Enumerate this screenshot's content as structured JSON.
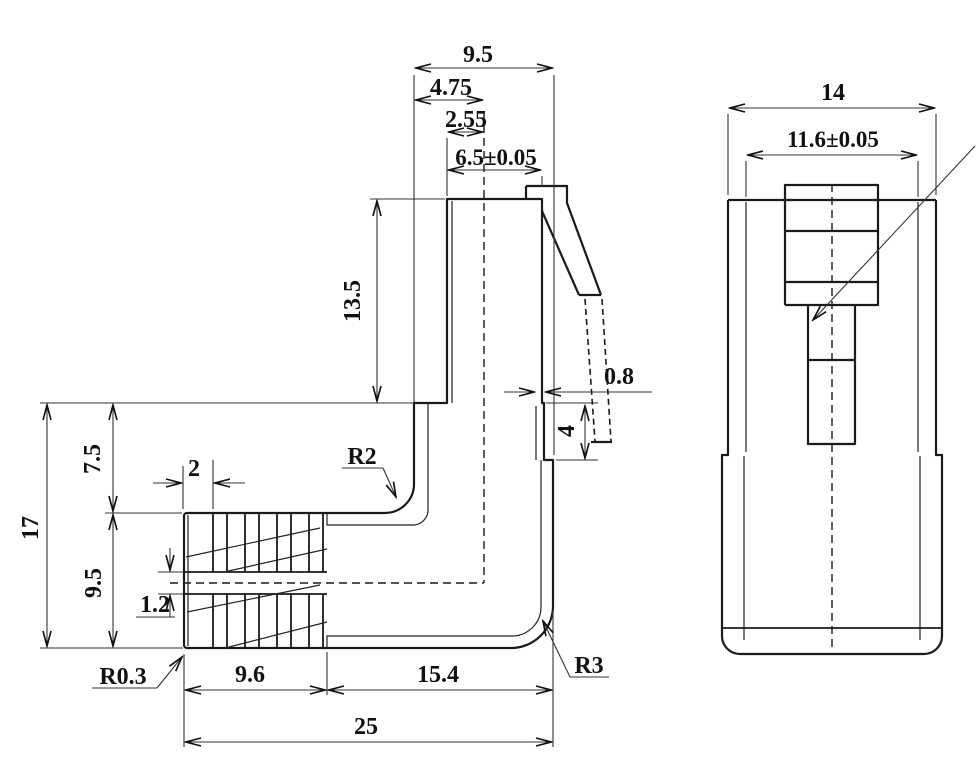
{
  "side_view": {
    "plug_width": "9.5",
    "plug_half_width": "4.75",
    "contact_offset": "2.55",
    "plug_tip_width": "6.5±0.05",
    "plug_height": "13.5",
    "wall_thickness": "0.8",
    "latch_recess_height": "4",
    "overall_height": "17",
    "upper_height": "7.5",
    "boot_height": "9.5",
    "rib_pitch": "2",
    "rib_web": "1.2",
    "inner_corner_radius": "R2",
    "edge_radius": "R0.3",
    "boot_length": "9.6",
    "body_length": "15.4",
    "overall_length": "25",
    "outer_corner_radius": "R3"
  },
  "end_view": {
    "overall_width": "14",
    "plug_body_width": "11.6±0.05"
  }
}
